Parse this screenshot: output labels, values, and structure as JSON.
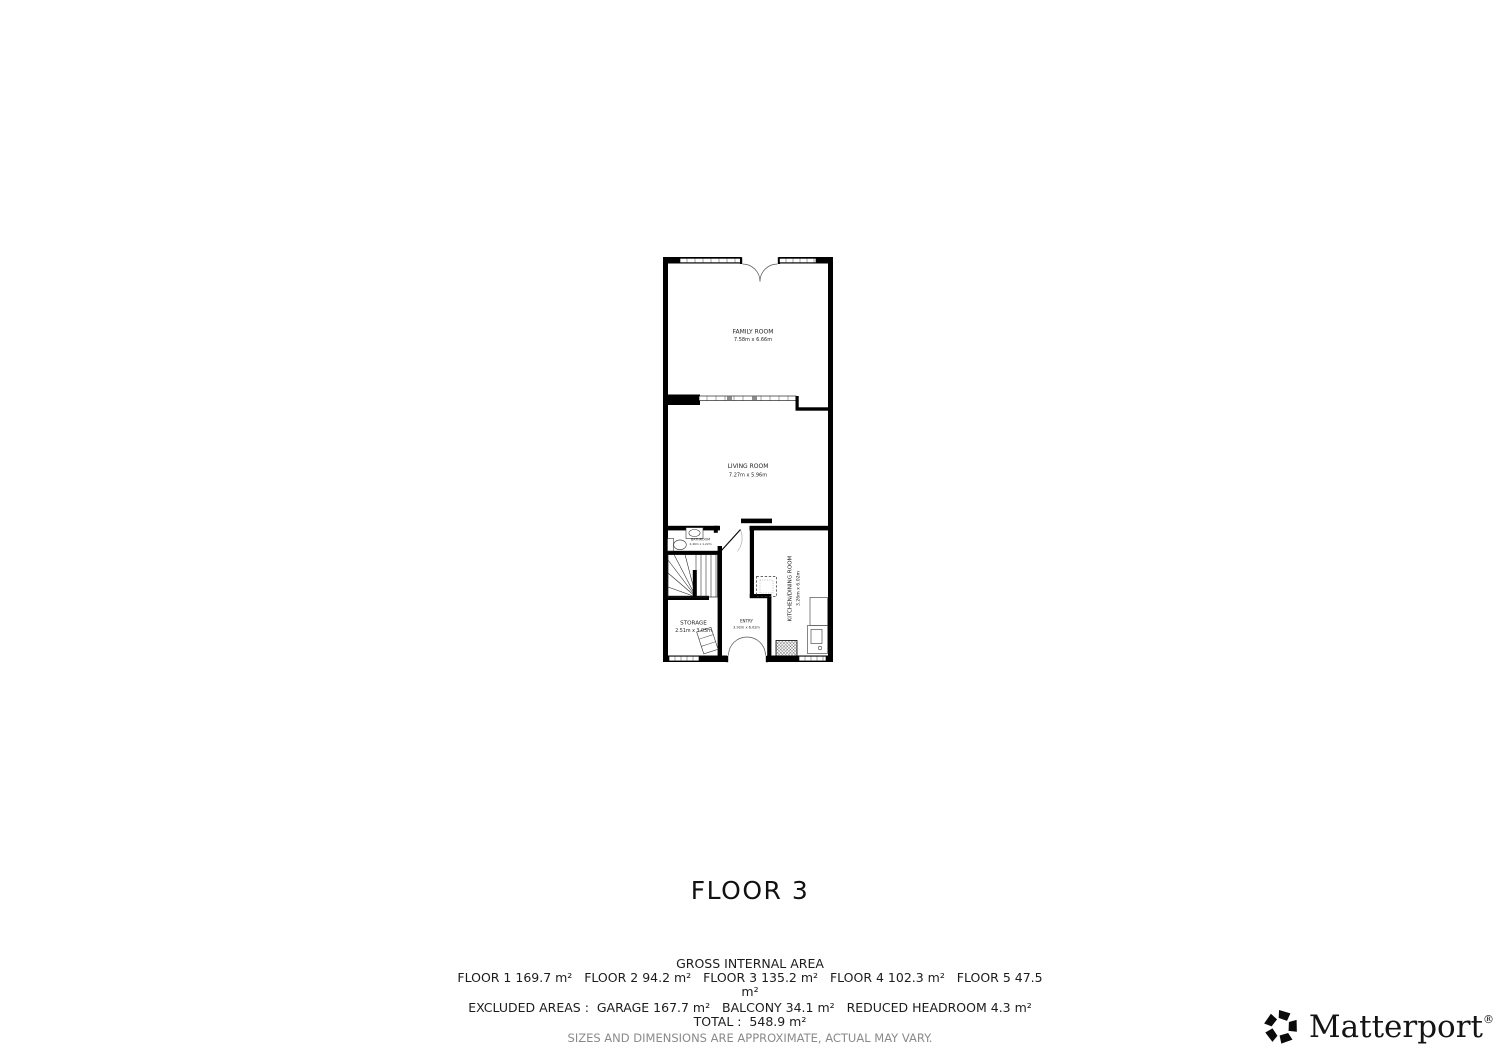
{
  "floor_title": "FLOOR 3",
  "floorplan": {
    "rooms": [
      {
        "id": "family-room",
        "name": "FAMILY ROOM",
        "dims": "7.58m x 6.66m"
      },
      {
        "id": "living-room",
        "name": "LIVING ROOM",
        "dims": "7.27m x 5.96m"
      },
      {
        "id": "bathroom",
        "name": "BATHROOM",
        "dims": "2.46m x 1.22m"
      },
      {
        "id": "storage",
        "name": "STORAGE",
        "dims": "2.51m x 3.03m"
      },
      {
        "id": "entry",
        "name": "ENTRY",
        "dims": "3.92m x 6.02m"
      },
      {
        "id": "kitchen-dining-room",
        "name": "KITCHEN/DINING ROOM",
        "dims": "3.26m x 6.02m"
      }
    ]
  },
  "gross_internal_area": {
    "heading": "GROSS INTERNAL AREA",
    "floors": [
      {
        "label": "FLOOR 1",
        "area": "169.7 m²"
      },
      {
        "label": "FLOOR 2",
        "area": "94.2 m²"
      },
      {
        "label": "FLOOR 3",
        "area": "135.2 m²"
      },
      {
        "label": "FLOOR 4",
        "area": "102.3 m²"
      },
      {
        "label": "FLOOR 5",
        "area": "47.5 m²"
      }
    ],
    "floor_lines": [
      "FLOOR 1 169.7 m²   FLOOR 2 94.2 m²   FLOOR 3 135.2 m²   FLOOR 4 102.3 m²   FLOOR 5 47.5",
      "m²"
    ],
    "excluded": [
      {
        "label": "GARAGE",
        "area": "167.7 m²"
      },
      {
        "label": "BALCONY",
        "area": "34.1 m²"
      },
      {
        "label": "REDUCED HEADROOM",
        "area": "4.3 m²"
      }
    ],
    "excluded_line": "EXCLUDED AREAS :  GARAGE 167.7 m²   BALCONY 34.1 m²   REDUCED HEADROOM 4.3 m²",
    "total_line": "TOTAL :  548.9 m²",
    "disclaimer": "SIZES AND DIMENSIONS ARE APPROXIMATE, ACTUAL MAY VARY."
  },
  "branding": {
    "name": "Matterport",
    "registered_mark": "®"
  },
  "colors": {
    "wall": "#000000",
    "label": "#1f1f1f",
    "disclaimer_text": "#8a8a8a"
  }
}
